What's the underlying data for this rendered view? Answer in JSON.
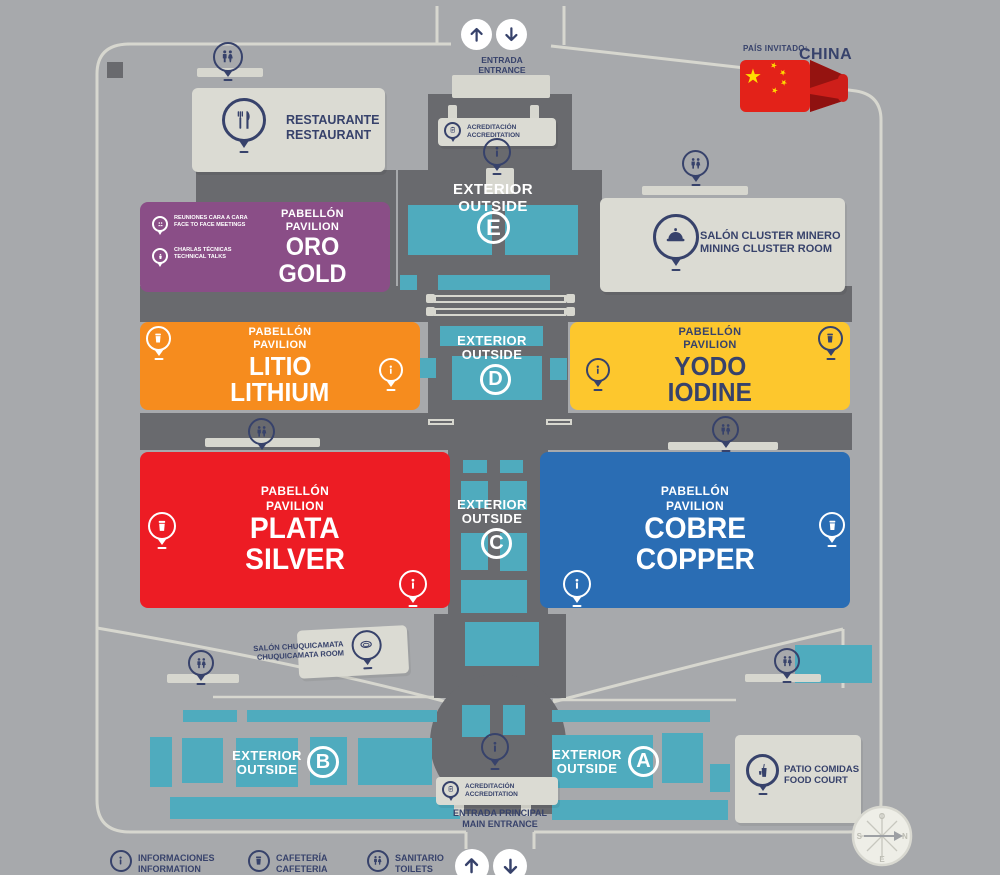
{
  "palette": {
    "background": "#A7A9AC",
    "building_gray": "#696A6E",
    "booth_teal": "#4FABBE",
    "surface_light": "#DBDBD3",
    "walkway_line": "#D7D7CF",
    "navy_text": "#37426B",
    "gold_purple": "#8A4E87",
    "lithium_orange": "#F68C1E",
    "iodine_yellow": "#FDC72D",
    "silver_red": "#ED1C24",
    "copper_blue": "#2A6DB4",
    "flag_red": "#E32219",
    "flag_gold": "#FFDE00"
  },
  "top_entrance": {
    "line1": "ENTRADA",
    "line2": "ENTRANCE"
  },
  "guest_country": {
    "label": "PAÍS INVITADO:",
    "name": "CHINA"
  },
  "accreditation": {
    "line1": "ACREDITACIÓN",
    "line2": "ACCREDITATION"
  },
  "main_entrance": {
    "line1": "ENTRADA PRINCIPAL",
    "line2": "MAIN ENTRANCE"
  },
  "rooms": {
    "restaurant": {
      "line1": "RESTAURANTE",
      "line2": "RESTAURANT"
    },
    "mining_cluster": {
      "line1": "SALÓN CLUSTER MINERO",
      "line2": "MINING CLUSTER ROOM"
    },
    "chuquicamata": {
      "line1": "SALÓN CHUQUICAMATA",
      "line2": "CHUQUICAMATA ROOM"
    },
    "food_court": {
      "line1": "PATIO COMIDAS",
      "line2": "FOOD COURT"
    }
  },
  "pavilions": {
    "gold": {
      "type_es": "PABELLÓN",
      "type_en": "PAVILION",
      "name_es": "ORO",
      "name_en": "GOLD",
      "features": [
        {
          "line1": "REUNIONES CARA A CARA",
          "line2": "FACE TO FACE MEETINGS"
        },
        {
          "line1": "CHARLAS TÉCNICAS",
          "line2": "TECHNICAL TALKS"
        }
      ]
    },
    "lithium": {
      "type_es": "PABELLÓN",
      "type_en": "PAVILION",
      "name_es": "LITIO",
      "name_en": "LITHIUM"
    },
    "iodine": {
      "type_es": "PABELLÓN",
      "type_en": "PAVILION",
      "name_es": "YODO",
      "name_en": "IODINE"
    },
    "silver": {
      "type_es": "PABELLÓN",
      "type_en": "PAVILION",
      "name_es": "PLATA",
      "name_en": "SILVER"
    },
    "copper": {
      "type_es": "PABELLÓN",
      "type_en": "PAVILION",
      "name_es": "COBRE",
      "name_en": "COPPER"
    }
  },
  "exterior_zones": {
    "e": {
      "line1": "EXTERIOR",
      "line2": "OUTSIDE",
      "letter": "E"
    },
    "d": {
      "line1": "EXTERIOR",
      "line2": "OUTSIDE",
      "letter": "D"
    },
    "c": {
      "line1": "EXTERIOR",
      "line2": "OUTSIDE",
      "letter": "C"
    },
    "b": {
      "line1": "EXTERIOR",
      "line2": "OUTSIDE",
      "letter": "B"
    },
    "a": {
      "line1": "EXTERIOR",
      "line2": "OUTSIDE",
      "letter": "A"
    }
  },
  "legend": {
    "information": {
      "line1": "INFORMACIONES",
      "line2": "INFORMATION"
    },
    "cafeteria": {
      "line1": "CAFETERÍA",
      "line2": "CAFETERIA"
    },
    "toilets": {
      "line1": "SANITARIO",
      "line2": "TOILETS"
    }
  },
  "compass": {
    "top": "O",
    "right": "N",
    "left": "S",
    "bottom": "E"
  }
}
